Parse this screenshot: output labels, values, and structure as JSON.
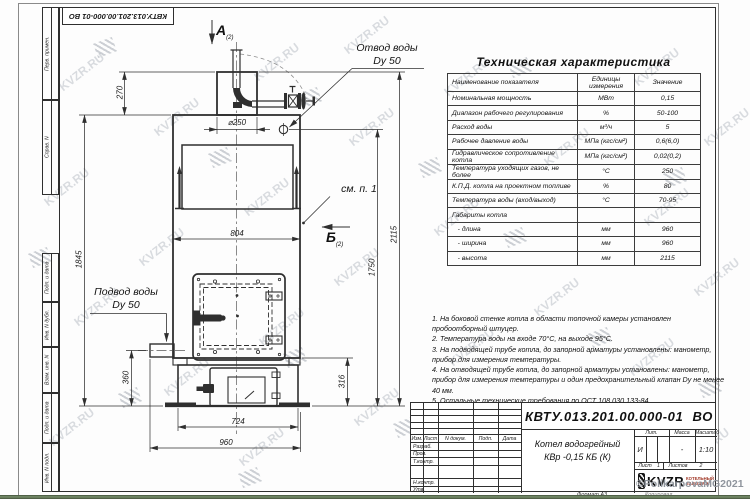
{
  "frame": {
    "left_fields": [
      "Перв. примен.",
      "Справ. N",
      "Подп. и дата",
      "Инв. N дубл.",
      "Взам. инв. N",
      "Подп. и дата",
      "Инв. N подл."
    ],
    "format_label": "Формат А3",
    "copied_label": "Копировал"
  },
  "table": {
    "title": "Техническая характеристика",
    "headers": [
      "Наименование показателя",
      "Единицы измерения",
      "Значение"
    ],
    "rows": [
      [
        "Номинальная мощность",
        "МВт",
        "0,15"
      ],
      [
        "Диапазон рабочего регулирования",
        "%",
        "50-100"
      ],
      [
        "Расход воды",
        "м³/ч",
        "5"
      ],
      [
        "Рабочее давление воды",
        "МПа (кгс/см²)",
        "0,6(6,0)"
      ],
      [
        "Гидравлическое сопротивление котла",
        "МПа (кгс/см²)",
        "0,02(0,2)"
      ],
      [
        "Температура уходящих газов, не более",
        "°С",
        "250"
      ],
      [
        "К.П.Д. котла на проектном топливе",
        "%",
        "80"
      ],
      [
        "Температура воды (вход/выход)",
        "°С",
        "70-95"
      ],
      [
        "Габариты котла",
        "",
        ""
      ],
      [
        "   - длина",
        "мм",
        "960"
      ],
      [
        "   - ширина",
        "мм",
        "960"
      ],
      [
        "   - высота",
        "мм",
        "2115"
      ]
    ]
  },
  "notes": [
    "1. На боковой стенке котла в области топочной камеры установлен пробоотборный штуцер.",
    "2. Температура воды на входе 70°С, на выходе 95°С.",
    "3. На подводящей трубе котла, до запорной арматуры установлены: манометр, прибор для измерения температуры.",
    "4. На отводящей трубе котла, до запорной арматуры установлены: манометр, прибор для измерения температуры и один предохранительный клапан Dу не менее 40 мм.",
    "5. Остальные технические требования по ОСТ 108.030.133-84."
  ],
  "drawing": {
    "labels": {
      "outlet_line1": "Отвод воды",
      "outlet_line2": "Dy 50",
      "inlet_line1": "Подвод воды",
      "inlet_line2": "Dy 50",
      "see_note": "см. п. 1",
      "view_a": "А",
      "view_b": "Б",
      "view_sub": "(2)"
    },
    "dimensions": {
      "d250": "⌀250",
      "w804": "804",
      "h270": "270",
      "h1845": "1845",
      "h360": "360",
      "h316": "316",
      "h1750": "1750",
      "h2115": "2115",
      "w724": "724",
      "w960": "960"
    }
  },
  "title_block": {
    "designation": "КВТУ.013.201.00.000-01 ВО",
    "product_line1": "Котел водогрейный",
    "product_line2": "КВр -0,15  КБ  (К)",
    "header_cols": [
      "Изм.",
      "Лист",
      "N докум.",
      "Подп.",
      "Дата"
    ],
    "sign_rows": [
      "Разраб.",
      "Пров.",
      "Т.контр.",
      "Н.контр.",
      "Утв."
    ],
    "lit_label": "Лит.",
    "mass_label": "Масса",
    "scale_label": "Масштаб",
    "lit_value": "И",
    "mass_value": "-",
    "scale_value": "1:10",
    "sheet_label": "Лист",
    "sheet_value": "1",
    "sheets_label": "Листов",
    "sheets_value": "2",
    "logo_text": "KVZR",
    "logo_side1": "КОТЕЛЬНЫЙ",
    "logo_side2": "ЗАВОД РЭП"
  },
  "watermark": {
    "text": "KVZR.RU",
    "credit": "©PolikarpovaMG2021"
  },
  "colors": {
    "line": "#2f2f2f",
    "green_bar": "#5c7153",
    "logo_red": "#a03524",
    "watermark_gray": "#a7adb6"
  }
}
